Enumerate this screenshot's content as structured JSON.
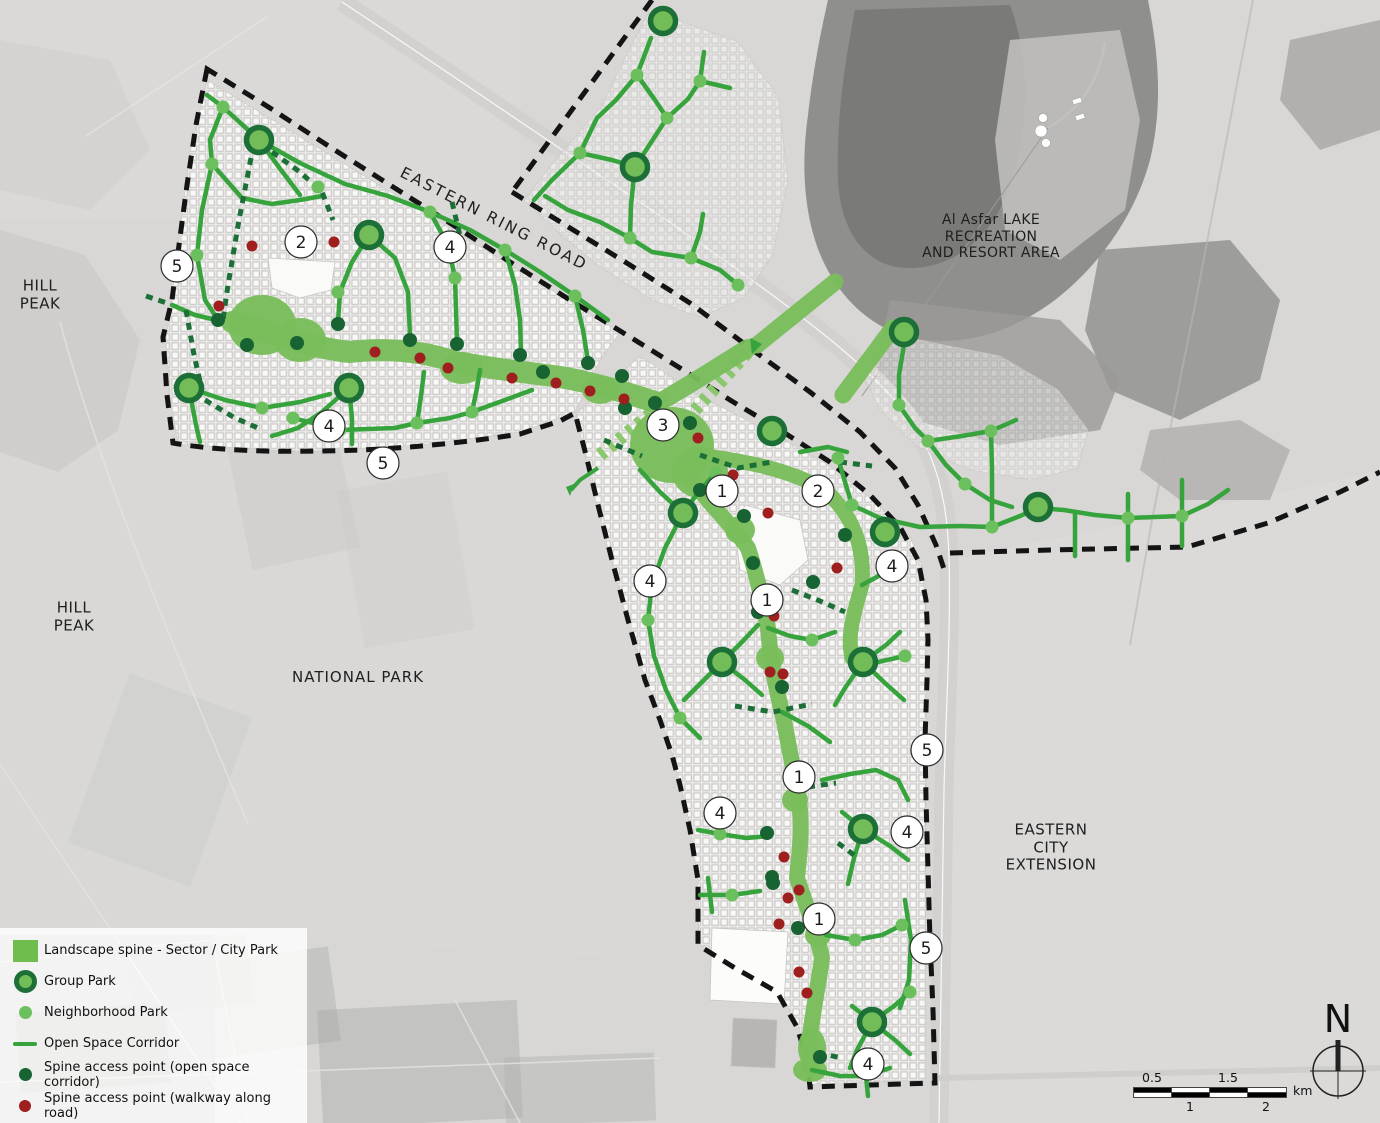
{
  "legend": {
    "items": [
      {
        "symbol": "spine-square",
        "label": "Landscape spine - Sector / City Park"
      },
      {
        "symbol": "group-park",
        "label": "Group Park"
      },
      {
        "symbol": "neighborhood-park",
        "label": "Neighborhood Park"
      },
      {
        "symbol": "open-space-corridor",
        "label": "Open Space Corridor"
      },
      {
        "symbol": "spine-access-open",
        "label": "Spine access point (open space corridor)"
      },
      {
        "symbol": "spine-access-walkway",
        "label": "Spine access point (walkway along road)"
      }
    ]
  },
  "labels": {
    "hill_peak_1": {
      "lines": [
        "HILL",
        "PEAK"
      ]
    },
    "hill_peak_2": {
      "lines": [
        "HILL",
        "PEAK"
      ]
    },
    "national_park": {
      "lines": [
        "NATIONAL PARK"
      ]
    },
    "eastern_ring_road": {
      "lines": [
        "EASTERN RING ROAD"
      ]
    },
    "lake": {
      "lines": [
        "Al Asfar LAKE",
        "RECREATION",
        "AND RESORT AREA"
      ]
    },
    "eastern_city_extension": {
      "lines": [
        "EASTERN",
        "CITY",
        "EXTENSION"
      ]
    }
  },
  "north": {
    "letter": "N"
  },
  "scale_bar": {
    "top_labels": [
      "0.5",
      "1.5"
    ],
    "bottom_labels": [
      "1",
      "2"
    ],
    "unit": "km"
  },
  "colors": {
    "spine": "#79bd5b",
    "corridor": "#36a33c",
    "corridor_dark": "#1d6f38",
    "hatch": "#8bc76e",
    "group_ring": "#1d6f38",
    "group_fill": "#72bd58",
    "nb_dot": "#6cbf5d",
    "access_open": "#176331",
    "access_walkway": "#9f1f1f",
    "boundary": "#141414",
    "road": "#d2d1cf",
    "lake": "#8f8f8d"
  },
  "map": {
    "desert": {
      "patches": [
        {
          "d": "M0,0 L520,0 520,220 0,220 Z",
          "fill": "#dcdbd9",
          "o": 0.5
        },
        {
          "d": "M950,560 L1380,472 1380,1123 939,1123 944,790 949,558 Z",
          "fill": "#dcdbd9",
          "o": 0.8
        },
        {
          "d": "M0,470 L163,340 173,445 575,415 660,720 698,945 660,960 300,940 0,930 Z",
          "fill": "#dad9d7",
          "o": 0.6
        },
        {
          "d": "M0,230 L85,255 140,340 118,430 58,472 0,452 Z",
          "fill": "#c8c7c5",
          "o": 0.55
        },
        {
          "d": "M0,40 L110,60 150,150 90,210 0,190 Z",
          "fill": "#cecdcb",
          "o": 0.5
        }
      ],
      "fields": [
        [
          0,
          935,
          215,
          188,
          "#a9a8a6",
          0.55,
          0
        ],
        [
          18,
          1008,
          150,
          80,
          "#8f8e8c",
          0.5,
          -4
        ],
        [
          130,
          940,
          120,
          70,
          "#b4b3b1",
          0.5,
          -6
        ],
        [
          205,
          955,
          130,
          95,
          "#b0afad",
          0.45,
          -8
        ],
        [
          320,
          1005,
          200,
          118,
          "#a5a4a2",
          0.4,
          -3
        ],
        [
          505,
          1055,
          150,
          68,
          "#b2b1af",
          0.45,
          -2
        ],
        [
          238,
          430,
          110,
          130,
          "#c6c5c3",
          0.35,
          -12
        ],
        [
          350,
          480,
          112,
          160,
          "#c9c8c6",
          0.3,
          -10
        ],
        [
          95,
          690,
          130,
          180,
          "#c3c2c0",
          0.3,
          20
        ]
      ],
      "minor_roads": [
        "M86,136 L268,16",
        "M60,322 C100,470 170,640 248,824",
        "M0,764 L240,1123",
        "M0,1082 L660,1058",
        "M212,938 L248,1123",
        "M0,962 L210,940",
        "M455,1000 L520,1123"
      ]
    },
    "lake": {
      "shapes": [
        {
          "d": "M828,0 L1148,0 C1160,60 1162,110 1150,160 C1135,215 1100,265 1055,300 C1015,330 970,345 925,340 C880,335 845,305 825,265 C805,225 800,170 808,115 C813,72 820,35 828,0 Z",
          "fill": "#8f8f8d",
          "o": 1
        },
        {
          "d": "M855,10 L1010,5 C1030,60 1030,120 1012,180 C995,235 955,270 905,268 C865,266 840,230 838,180 C836,120 845,60 855,10 Z",
          "fill": "#7a7a78",
          "o": 1
        },
        {
          "d": "M1010,40 L1120,30 1140,120 1125,210 1060,260 1005,230 995,140 Z",
          "fill": "#c3c2c0",
          "o": 0.85
        },
        {
          "d": "M1100,250 L1230,240 1280,300 1260,380 1180,420 1110,390 1085,330 Z",
          "fill": "#8e8e8c",
          "o": 0.8
        },
        {
          "d": "M1290,40 L1380,20 1380,130 1320,150 1280,100 Z",
          "fill": "#a7a6a4",
          "o": 0.8
        },
        {
          "d": "M1150,430 L1240,420 1290,450 1270,500 1180,500 1140,470 Z",
          "fill": "#a3a2a0",
          "o": 0.6
        },
        {
          "d": "M890,300 L1060,320 1120,380 1100,430 1000,445 915,420 875,370 Z",
          "fill": "#9b9a98",
          "o": 0.8
        }
      ]
    },
    "roads": {
      "ring_road": "M342,2 C430,60 520,122 610,182 C700,242 780,298 838,346 C888,388 915,420 930,455 C943,487 948,520 949,558 C951,625 946,710 944,790 C942,880 940,1000 939,1123",
      "branch": "M939,1078 L1380,1068",
      "resort_access": "M1105,42 C1098,88 1075,112 1048,128",
      "leader": "M1048,128 L862,396",
      "rail": "M1253,0 L1196,300 1152,520 1130,645"
    },
    "fabric": [
      {
        "d": "M207,80 L620,332 600,360 575,412 520,432 420,445 300,452 178,444 170,396 166,340 178,246 190,152 Z",
        "o": 0.95
      },
      {
        "d": "M640,356 L700,396 770,432 830,466 880,506 910,536 922,566 927,620 926,760 925,1080 812,1084 799,1028 779,992 736,967 699,944 698,880 689,820 673,756 656,706 641,666 626,616 611,560 597,506 585,456 576,414 Z",
        "o": 0.95
      },
      {
        "d": "M650,10 L738,42 778,96 788,180 773,254 744,298 700,317 652,300 602,268 562,236 524,200 562,152 602,106 628,52 Z",
        "o": 0.5
      },
      {
        "d": "M878,332 L1000,356 1058,390 1088,430 1078,468 1030,480 970,470 916,446 880,410 862,372 Z",
        "o": 0.45
      }
    ],
    "white_areas": [
      {
        "d": "M268,258 L335,262 331,290 300,298 272,288 Z",
        "fill": "#fafaf9"
      },
      {
        "d": "M745,505 L800,520 808,560 780,585 740,570 735,530 Z",
        "fill": "#fafaf9"
      },
      {
        "d": "M712,928 L788,932 784,1004 710,1000 Z",
        "fill": "#fcfcfb"
      },
      {
        "d": "M733,1018 L777,1020 775,1068 731,1066 Z",
        "fill": "#b7b6b4"
      }
    ],
    "boundaries": [
      "M207,69 L196,125 187,185 179,245 172,300 163,337 167,395 173,443 C230,453 300,452 360,450 C410,448 470,442 520,434 L560,421 575,413 L586,455 598,505 612,560 628,620 645,680 660,720 672,755 680,785 690,830 698,880 698,945 L735,968 777,992 797,1027 807,1060 810,1087 L870,1085 935,1083 L933,1010 930,940 928,870 926,800 925,740 927,680 928,640 926,600 918,560 900,527 870,495 830,462 780,430 730,400 680,368 630,337 570,300 510,262 450,223 390,185 330,147 270,108 Z",
      "M512,192 L570,228 630,265 690,303 750,348 810,392 860,432 895,468 918,505 936,545 945,572",
      "M950,553 L1050,550 1187,547 1268,523 1340,492 1380,472",
      "M652,0 L512,192"
    ],
    "hatched": [
      "M600,455 L660,406",
      "M695,410 L748,352"
    ],
    "arrows": [
      "750,338 762,344 752,354",
      "566,487 574,484 570,496"
    ],
    "arrow_lines": [
      "598,468 580,480 571,490"
    ],
    "spine_strokes": [
      {
        "w": 22,
        "d": "M232,322 C270,332 310,348 350,352 C385,348 420,350 455,362 C500,370 525,372 560,377 C595,383 628,393 658,403"
      },
      {
        "w": 18,
        "d": "M658,403 C690,385 720,365 748,348"
      },
      {
        "w": 15,
        "d": "M700,455 C750,462 790,470 825,490 C852,515 865,545 862,585 C850,625 848,640 852,658"
      },
      {
        "w": 16,
        "d": "M690,478 C710,505 732,525 748,548 C757,575 762,600 768,628 C770,655 775,685 782,712 C788,740 793,768 798,795 C803,822 800,850 797,878 C806,905 816,930 822,958 C818,988 812,1015 809,1045 L810,1068"
      },
      {
        "w": 17,
        "d": "M757,345 L835,282"
      },
      {
        "w": 17,
        "d": "M843,395 L893,328"
      }
    ],
    "spine_blobs": [
      [
        262,
        325,
        34,
        30
      ],
      [
        300,
        340,
        26,
        22
      ],
      [
        462,
        368,
        22,
        16
      ],
      [
        600,
        390,
        18,
        14
      ],
      [
        672,
        445,
        42,
        38
      ],
      [
        700,
        472,
        28,
        26
      ],
      [
        740,
        530,
        15,
        14
      ],
      [
        770,
        658,
        14,
        13
      ],
      [
        795,
        800,
        13,
        12
      ],
      [
        818,
        935,
        13,
        12
      ],
      [
        812,
        1048,
        14,
        20
      ],
      [
        810,
        1070,
        17,
        12
      ]
    ],
    "corridors": [
      "207,95 223,107 259,140",
      "259,140 300,163 345,184 388,196 430,212",
      "430,212 470,230 505,250 540,272 575,296 608,320",
      "223,107 210,140 212,164 202,210 197,255 205,300 218,320",
      "212,164 242,198 272,204 300,200 322,196",
      "369,235 352,262 340,292 338,322",
      "369,235 395,258 408,292 410,336",
      "430,212 448,245 455,278 457,342",
      "505,250 515,285 520,320 521,352",
      "575,296 583,330 588,361",
      "189,388 225,400 262,408 300,402 330,394",
      "189,388 196,425 200,442",
      "349,388 352,418 352,444",
      "349,388 322,412 298,428 272,436",
      "293,418 340,430 395,428 417,423 450,418 472,412 505,400 532,390",
      "417,423 421,396 424,372",
      "472,412 477,388 480,370",
      "172,305 195,315 216,320",
      "259,140 281,170 300,195",
      "651,38 637,75 616,100 597,118 580,153",
      "637,75 655,100 667,118",
      "667,118 688,99 700,81",
      "700,81 704,52",
      "700,81 730,88",
      "580,153 612,160 635,167",
      "635,167 667,118",
      "635,167 631,205 630,238",
      "630,238 600,222 568,210 545,196",
      "630,238 652,252 691,258 720,270 738,285",
      "691,258 700,232 703,214",
      "580,153 552,180 534,200",
      "904,345 899,375 899,405 915,428 928,441",
      "928,441 962,436 991,431 1016,420",
      "991,431 992,470 992,527",
      "928,441 946,465 965,484 990,500 1012,507",
      "920,527 960,526 992,527 1020,516 1038,508 1064,510 1095,515 1128,518 1155,517 1182,516 1208,504 1228,490",
      "852,505 880,518 920,527",
      "838,458 845,482 852,505",
      "1075,556 1075,514",
      "1128,560 1128,494",
      "1182,546 1182,480",
      "640,470 660,492 683,513",
      "683,513 700,490 716,473",
      "683,513 665,548 652,584 648,620 654,656 666,690 680,718 700,738",
      "800,452 828,447 847,452",
      "862,585 886,572 906,562",
      "852,658 878,662 905,656",
      "722,662 742,642 758,625",
      "722,662 700,684 684,700",
      "722,662 745,680 762,695",
      "863,662 886,645 900,632",
      "863,662 845,688 835,705",
      "863,662 886,684 904,700",
      "768,628 790,636 812,640 835,632",
      "782,712 808,726 830,742",
      "698,830 720,834 746,838 770,836",
      "700,895 732,895 760,891",
      "712,912 710,895 708,878",
      "822,780 850,774 876,770 898,780 908,800",
      "863,829 842,812",
      "863,829 890,846 908,860",
      "863,829 854,858 848,884",
      "826,935 855,940 882,935 902,925",
      "905,900 911,940 909,980 900,1008",
      "872,1022 852,1006",
      "872,1022 895,1040 910,1054",
      "872,1022 857,1050 850,1068",
      "872,1022 894,1006 910,992",
      "812,1070 840,1076 866,1076 890,1068",
      "866,1076 868,1096"
    ],
    "corridors_dashed": [
      "251,158 239,220 228,285 223,320",
      "272,152 300,172 322,192 333,220",
      "186,310 194,355 202,390",
      "146,296 170,304",
      "205,400 235,418 258,428",
      "452,202 461,240",
      "700,455 738,468 772,462",
      "840,462 872,466",
      "792,590 820,601 845,612",
      "735,706 773,712 812,704",
      "808,787 836,783",
      "838,843 858,858",
      "818,1053 842,1058",
      "604,440 642,456"
    ],
    "nb_parks": [
      [
        223,
        107
      ],
      [
        212,
        164
      ],
      [
        318,
        187
      ],
      [
        430,
        212
      ],
      [
        505,
        250
      ],
      [
        575,
        296
      ],
      [
        197,
        255
      ],
      [
        293,
        418
      ],
      [
        340,
        430
      ],
      [
        417,
        423
      ],
      [
        472,
        412
      ],
      [
        262,
        408
      ],
      [
        338,
        292
      ],
      [
        455,
        278
      ],
      [
        637,
        75
      ],
      [
        700,
        81
      ],
      [
        667,
        118
      ],
      [
        580,
        153
      ],
      [
        630,
        238
      ],
      [
        691,
        258
      ],
      [
        738,
        285
      ],
      [
        899,
        405
      ],
      [
        928,
        441
      ],
      [
        965,
        484
      ],
      [
        991,
        431
      ],
      [
        992,
        527
      ],
      [
        1128,
        518
      ],
      [
        1182,
        516
      ],
      [
        852,
        505
      ],
      [
        648,
        620
      ],
      [
        680,
        718
      ],
      [
        905,
        656
      ],
      [
        838,
        458
      ],
      [
        716,
        473
      ],
      [
        812,
        640
      ],
      [
        720,
        834
      ],
      [
        732,
        895
      ],
      [
        855,
        940
      ],
      [
        902,
        925
      ],
      [
        910,
        992
      ],
      [
        852,
        658
      ]
    ],
    "group_parks": [
      [
        259,
        140
      ],
      [
        369,
        235
      ],
      [
        189,
        388
      ],
      [
        349,
        388
      ],
      [
        663,
        21
      ],
      [
        635,
        167
      ],
      [
        904,
        332
      ],
      [
        1038,
        507
      ],
      [
        772,
        431
      ],
      [
        683,
        513
      ],
      [
        885,
        532
      ],
      [
        722,
        662
      ],
      [
        863,
        662
      ],
      [
        863,
        829
      ],
      [
        872,
        1022
      ]
    ],
    "access_open": [
      [
        218,
        320
      ],
      [
        247,
        345
      ],
      [
        297,
        343
      ],
      [
        338,
        324
      ],
      [
        410,
        340
      ],
      [
        457,
        344
      ],
      [
        520,
        355
      ],
      [
        588,
        363
      ],
      [
        622,
        376
      ],
      [
        655,
        403
      ],
      [
        690,
        423
      ],
      [
        700,
        490
      ],
      [
        625,
        408
      ],
      [
        753,
        563
      ],
      [
        758,
        612
      ],
      [
        782,
        687
      ],
      [
        845,
        535
      ],
      [
        813,
        582
      ],
      [
        744,
        516
      ],
      [
        767,
        833
      ],
      [
        772,
        877
      ],
      [
        773,
        883
      ],
      [
        798,
        928
      ],
      [
        820,
        1057
      ],
      [
        543,
        372
      ]
    ],
    "access_walkway": [
      [
        252,
        246
      ],
      [
        334,
        242
      ],
      [
        219,
        306
      ],
      [
        375,
        352
      ],
      [
        420,
        358
      ],
      [
        448,
        368
      ],
      [
        512,
        378
      ],
      [
        556,
        383
      ],
      [
        590,
        391
      ],
      [
        624,
        399
      ],
      [
        698,
        438
      ],
      [
        733,
        475
      ],
      [
        768,
        513
      ],
      [
        774,
        616
      ],
      [
        837,
        568
      ],
      [
        770,
        672
      ],
      [
        783,
        674
      ],
      [
        784,
        857
      ],
      [
        788,
        898
      ],
      [
        799,
        890
      ],
      [
        779,
        924
      ],
      [
        799,
        972
      ],
      [
        807,
        993
      ]
    ],
    "markers": [
      [
        5,
        177,
        266
      ],
      [
        2,
        301,
        242
      ],
      [
        4,
        450,
        247
      ],
      [
        4,
        329,
        426
      ],
      [
        5,
        383,
        463
      ],
      [
        3,
        663,
        425
      ],
      [
        1,
        722,
        491
      ],
      [
        2,
        818,
        491
      ],
      [
        4,
        650,
        581
      ],
      [
        4,
        892,
        566
      ],
      [
        1,
        767,
        600
      ],
      [
        5,
        927,
        750
      ],
      [
        1,
        799,
        777
      ],
      [
        4,
        720,
        813
      ],
      [
        4,
        907,
        832
      ],
      [
        1,
        819,
        919
      ],
      [
        5,
        926,
        948
      ],
      [
        4,
        868,
        1064
      ]
    ],
    "resort": {
      "dots": [
        [
          1043,
          118,
          4.5
        ],
        [
          1041,
          131,
          6
        ],
        [
          1046,
          143,
          4.5
        ]
      ],
      "flags": [
        [
          1072,
          100
        ],
        [
          1075,
          116
        ]
      ]
    }
  }
}
